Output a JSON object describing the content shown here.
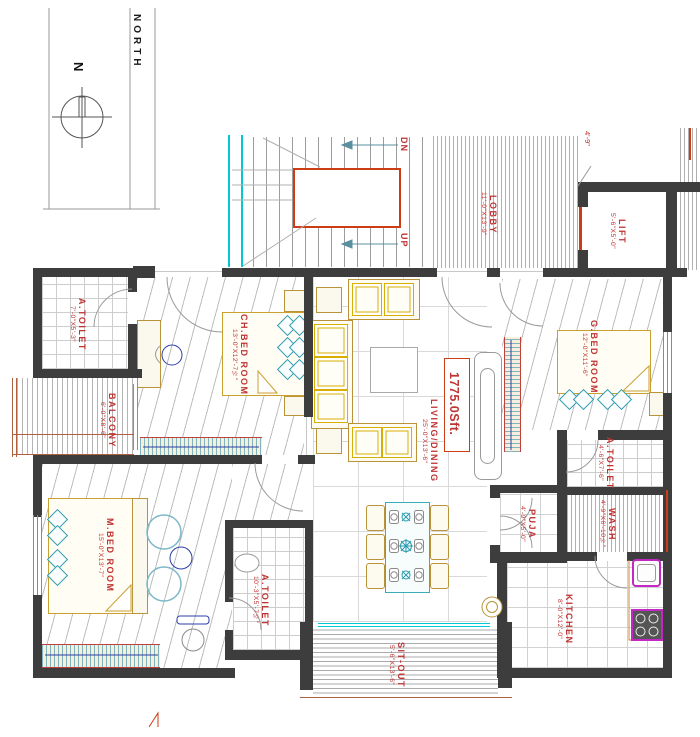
{
  "title": "Apartment Floor Plan",
  "colors": {
    "label_red": "#bf3333",
    "wall": "#3d3d3d",
    "accent_red": "#cc3d14",
    "cyan": "#00c8d4",
    "teal": "#2a9bae",
    "tan": "#b8933a",
    "yellow": "#d8ae00",
    "magenta": "#c428c4",
    "blue": "#2e3fa8"
  },
  "compass": {
    "n": "N",
    "north": "NORTH"
  },
  "stairs": {
    "dn": "DN",
    "up": "UP"
  },
  "area_label": "1775.0Sft.",
  "side_dim": "4'-9\"",
  "rooms": {
    "lobby": {
      "name": "LOBBY",
      "dim": "11'-0\"X13'-9\""
    },
    "lift": {
      "name": "LIFT",
      "dim": "5'-6\"X5'-0\""
    },
    "a_toilet_1": {
      "name": "A.TOILET",
      "dim": "7'-0\"X5'-3\""
    },
    "balcony": {
      "name": "BALCONY",
      "dim": "6'-0\"X8'-6\""
    },
    "ch_bed": {
      "name": "CH.BED ROOM",
      "dim": "13'-0\"X12'-7½\""
    },
    "living": {
      "name": "LIVING/DINING",
      "dim": "25'-0\"X13'-6\""
    },
    "g_bed": {
      "name": "G.BED ROOM",
      "dim": "12'-0\"X11'-6\""
    },
    "a_toilet_2": {
      "name": "A.TOILET",
      "dim": "4'-6\"X7'-6\""
    },
    "wash": {
      "name": "WASH",
      "dim": "4'-9\"X6'-10½\""
    },
    "puja": {
      "name": "PUJA",
      "dim": "4'-9\"X5'-0\""
    },
    "kitchen": {
      "name": "KITCHEN",
      "dim": "8'-0\"X12'-0\""
    },
    "m_bed": {
      "name": "M.BED ROOM",
      "dim": "15'-0\"X13'-7\""
    },
    "a_toilet_3": {
      "name": "A.TOILET",
      "dim": "10'-3\"X5'-7½\""
    },
    "sit_out": {
      "name": "SIT-OUT",
      "dim": "5'-6\"X13'-6\""
    }
  }
}
